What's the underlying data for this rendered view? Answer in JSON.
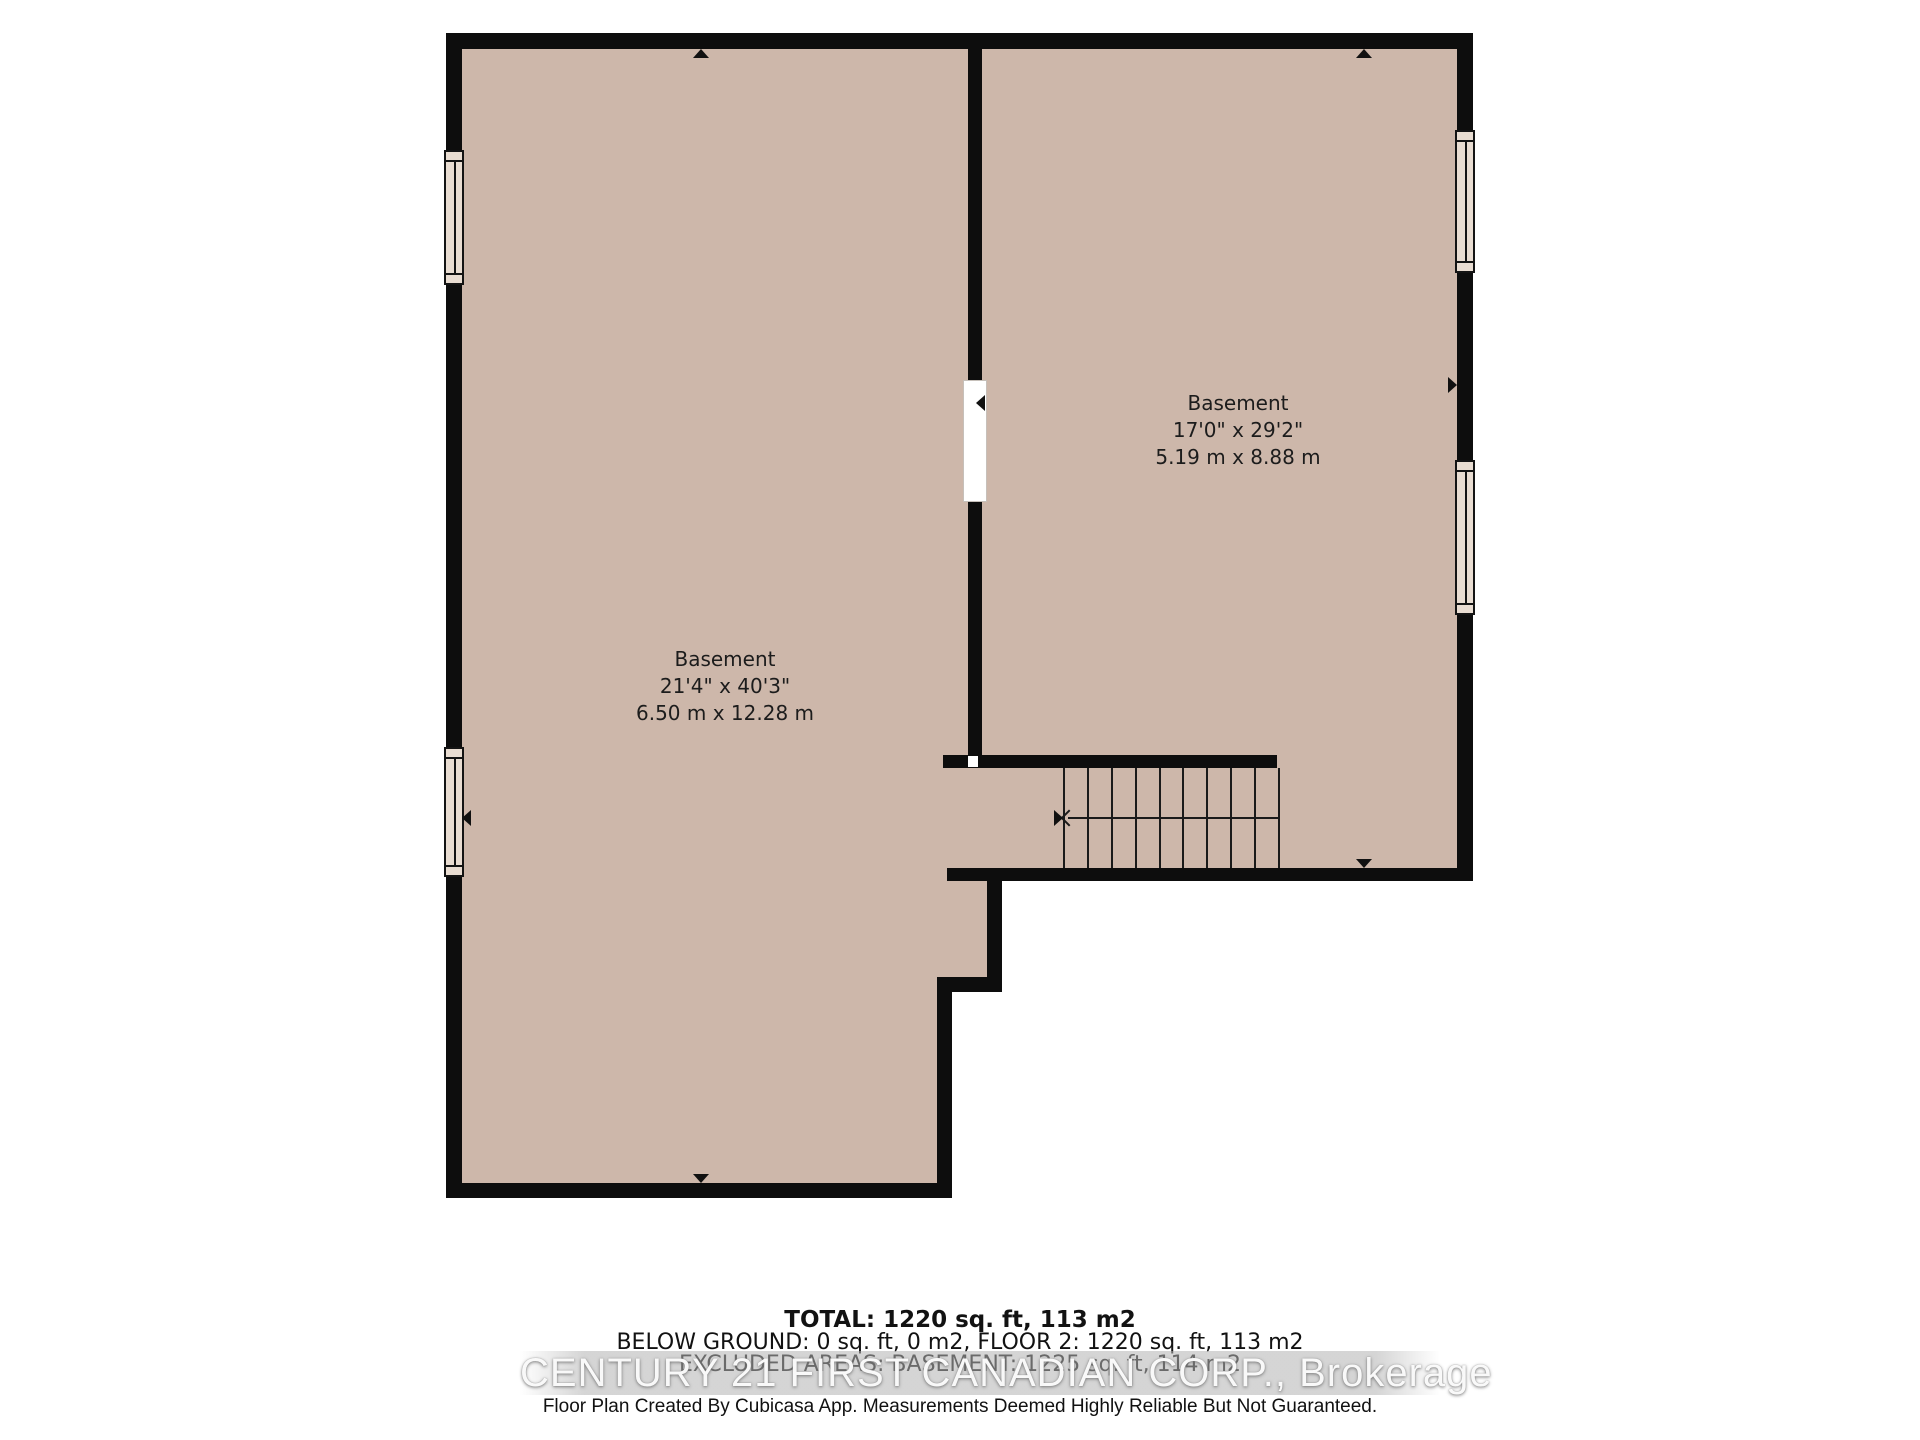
{
  "plan": {
    "type": "basement-floor-plan",
    "rooms": [
      {
        "name": "Basement",
        "imperial": "21'4\" x 40'3\"",
        "metric": "6.50 m x 12.28 m"
      },
      {
        "name": "Basement",
        "imperial": "17'0\" x 29'2\"",
        "metric": "5.19 m x 8.88 m"
      }
    ],
    "stairs": {
      "treads": 9,
      "direction": "left"
    }
  },
  "summary": {
    "total": "TOTAL: 1220 sq. ft, 113 m2",
    "below_ground": "BELOW GROUND: 0 sq. ft, 0 m2, FLOOR 2: 1220 sq. ft, 113 m2",
    "excluded": "EXCLUDED AREAS: BASEMENT: 1225 sq. ft, 114 m2"
  },
  "watermark": "CENTURY 21 FIRST CANADIAN CORP., Brokerage",
  "disclaimer": "Floor Plan Created By Cubicasa App. Measurements Deemed Highly Reliable But Not Guaranteed.",
  "colors": {
    "floor": "#cdb7aa",
    "wall": "#0d0d0d",
    "window_fill": "#e9ddd2",
    "background": "#ffffff",
    "watermark_text": "#ffffff"
  }
}
